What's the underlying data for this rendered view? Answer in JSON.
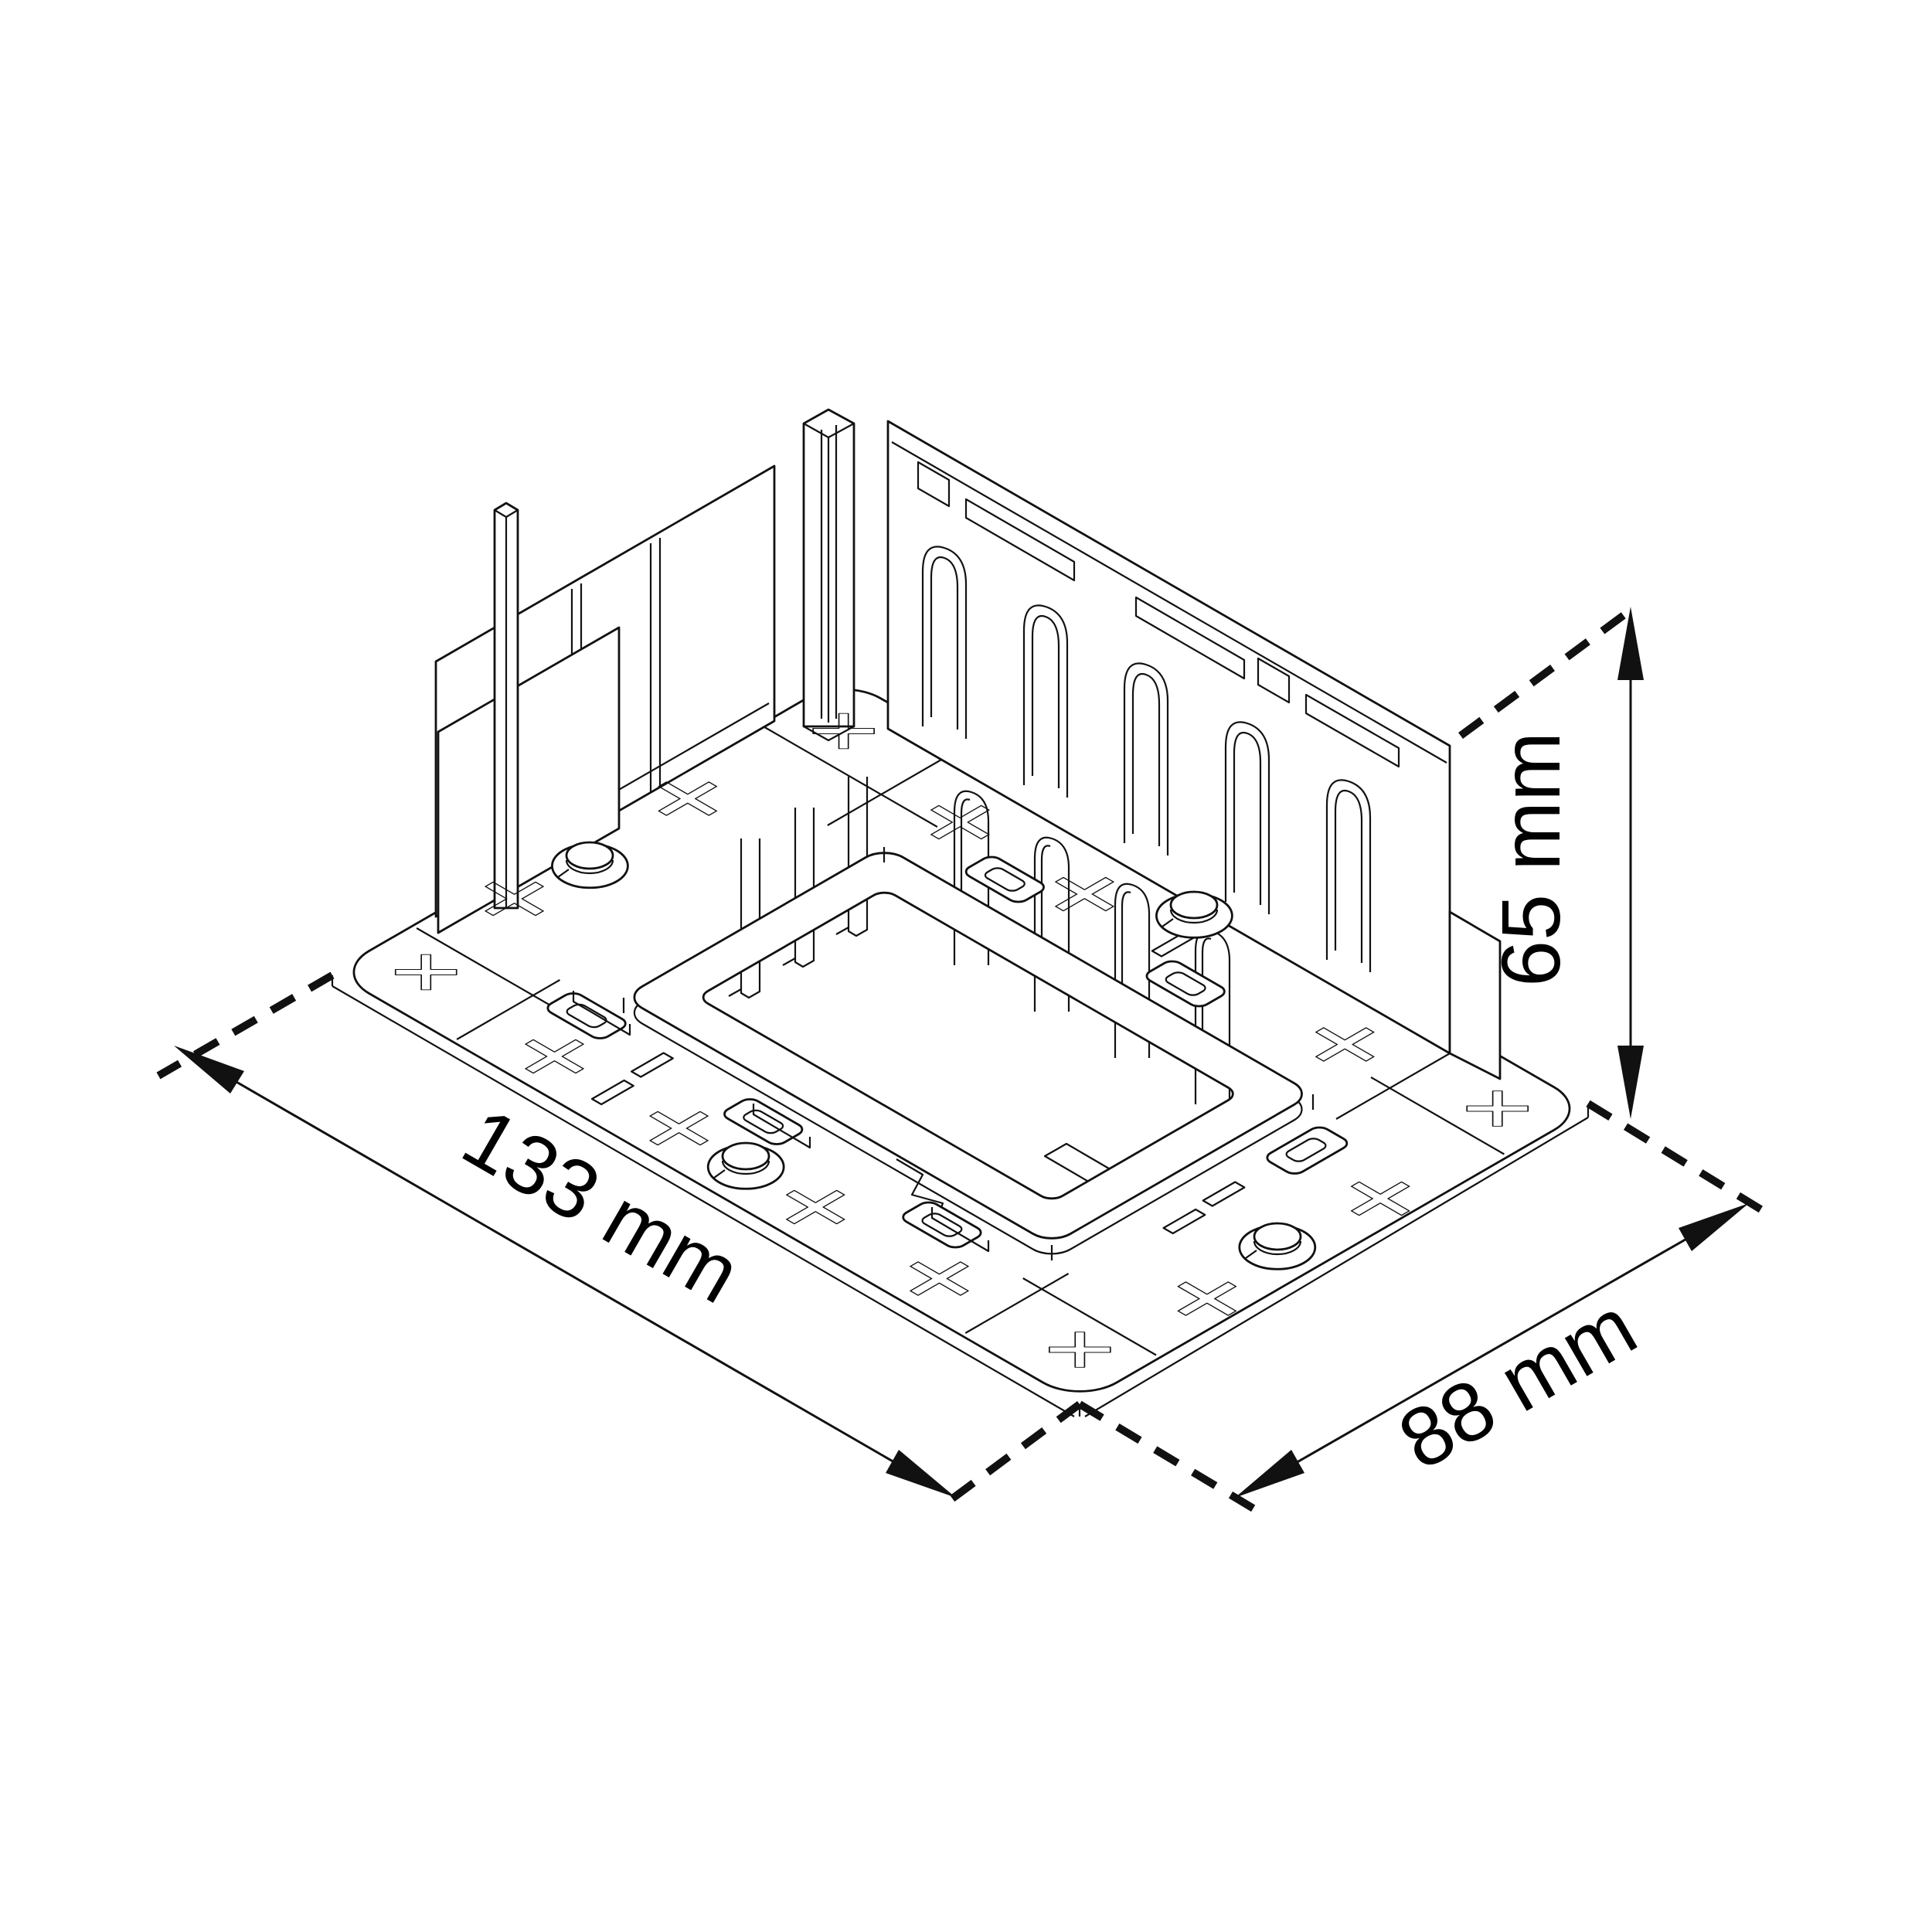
{
  "drawing": {
    "view": "isometric",
    "style": "monochrome line drawing"
  },
  "dimensions": {
    "width": {
      "label": "133 mm",
      "value": 133,
      "unit": "mm"
    },
    "depth": {
      "label": "88 mm",
      "value": 88,
      "unit": "mm"
    },
    "height": {
      "label": "65 mm",
      "value": 65,
      "unit": "mm"
    }
  },
  "colors": {
    "line": "#111111",
    "background": "#ffffff"
  }
}
